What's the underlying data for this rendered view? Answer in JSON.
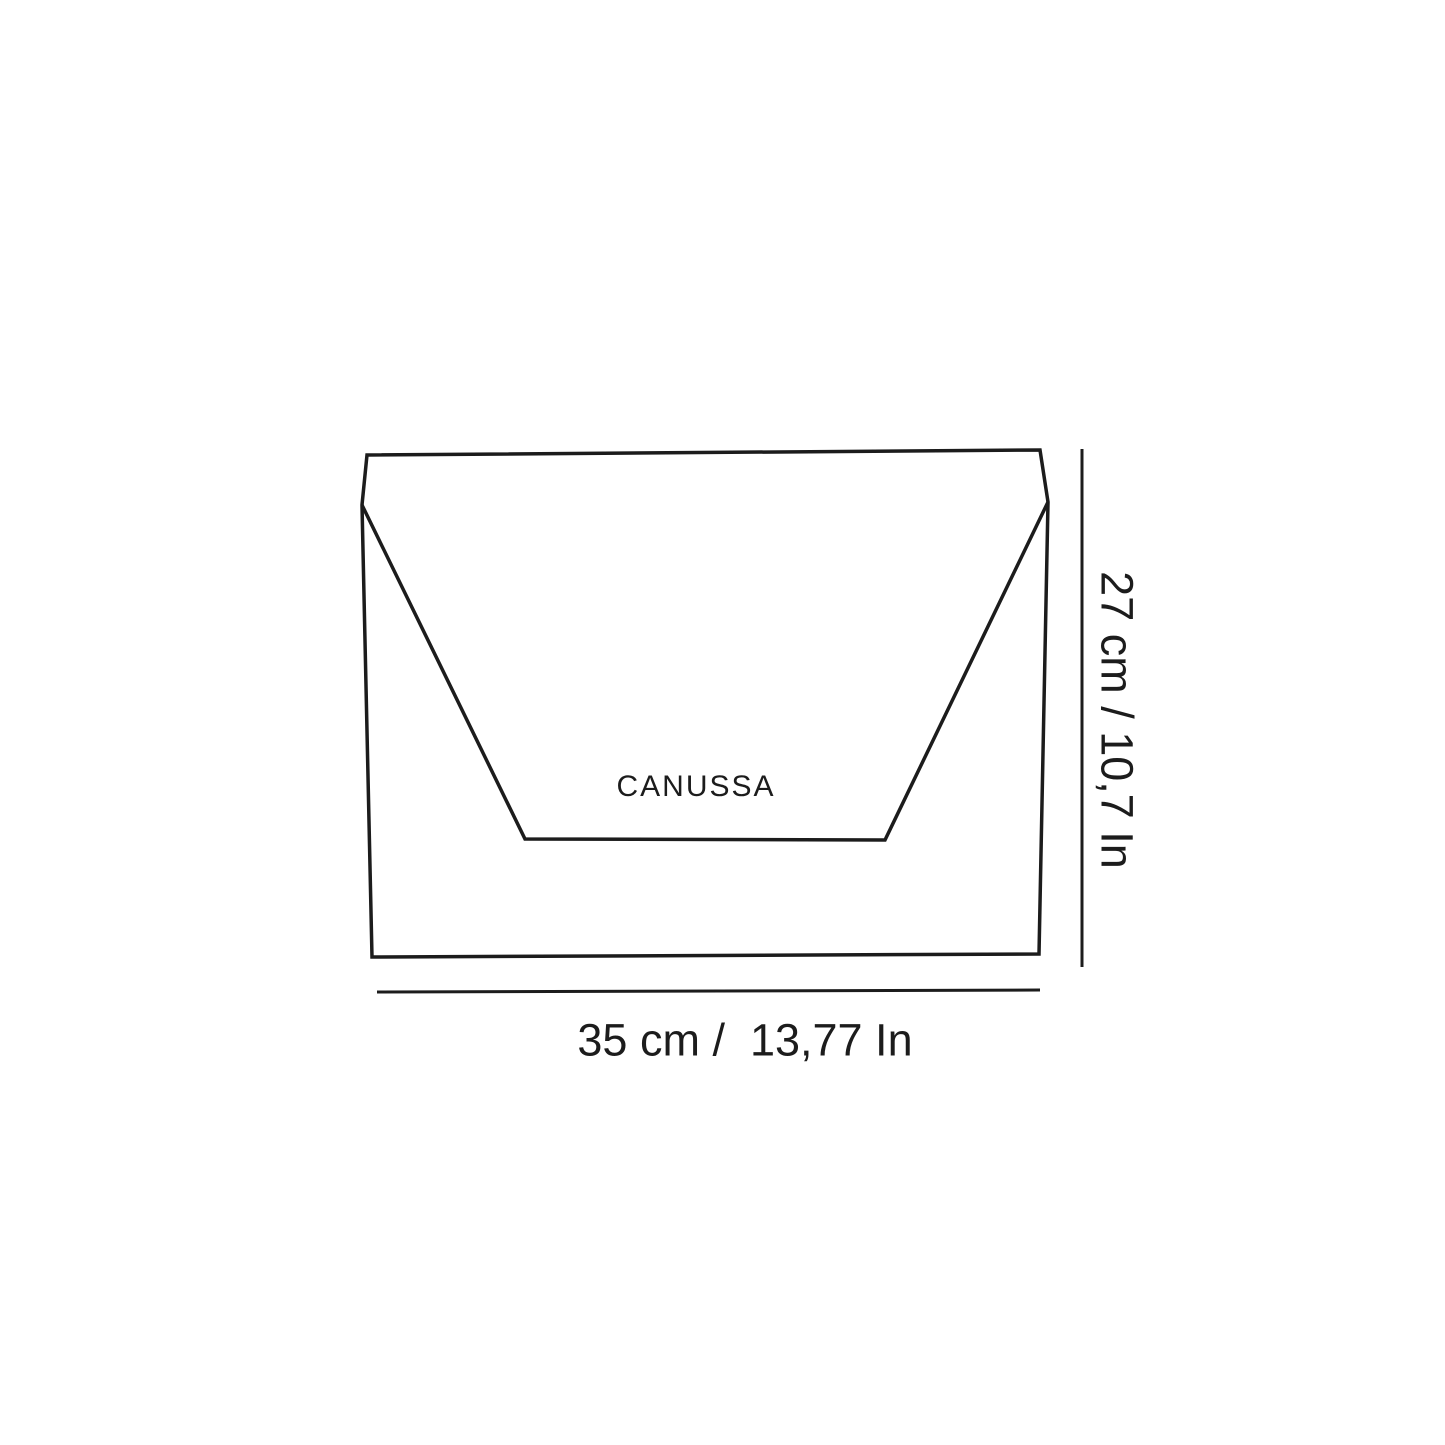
{
  "colors": {
    "ink": "#1c1c1c",
    "background": "#ffffff"
  },
  "diagram": {
    "brand_logo": "CANUSSA",
    "width_dimension_label": "35 cm /  13,77 In",
    "height_dimension_label": "27 cm / 10,7 In"
  }
}
